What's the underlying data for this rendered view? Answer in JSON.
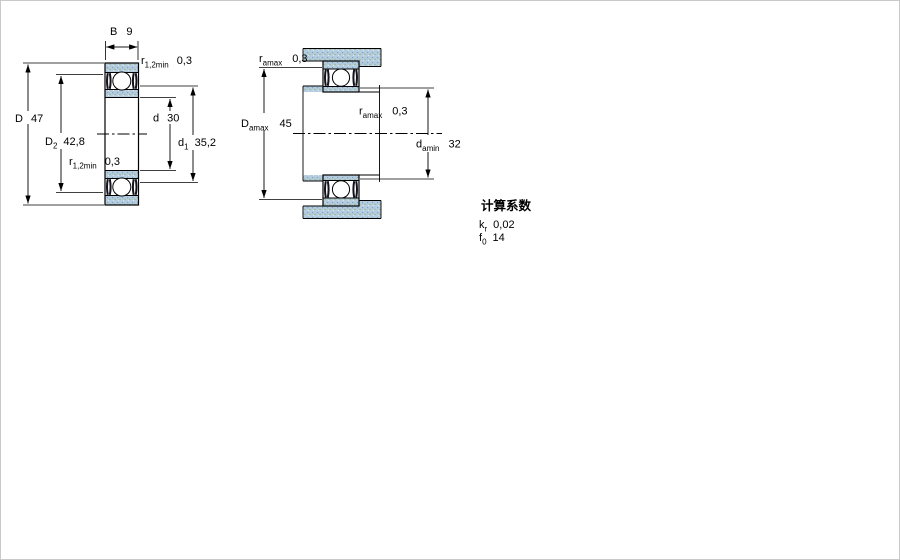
{
  "left_view": {
    "B": {
      "sym": "B",
      "val": "9"
    },
    "r_top": {
      "sym": "r",
      "sub": "1,2min",
      "val": "0,3"
    },
    "D": {
      "sym": "D",
      "val": "47"
    },
    "D2": {
      "sym": "D",
      "sub": "2",
      "val": "42,8"
    },
    "r_bottom": {
      "sym": "r",
      "sub": "1,2min",
      "val": "0,3"
    },
    "d": {
      "sym": "d",
      "val": "30"
    },
    "d1": {
      "sym": "d",
      "sub": "1",
      "val": "35,2"
    }
  },
  "right_view": {
    "ramax_top": {
      "sym": "r",
      "sub": "amax",
      "val": "0,3"
    },
    "Damax": {
      "sym": "D",
      "sub": "amax",
      "val": "45"
    },
    "ramax_mid": {
      "sym": "r",
      "sub": "amax",
      "val": "0,3"
    },
    "damin": {
      "sym": "d",
      "sub": "amin",
      "val": "32"
    }
  },
  "factors": {
    "heading": "计算系数",
    "kr": {
      "sym": "k",
      "sub": "r",
      "val": "0,02"
    },
    "f0": {
      "sym": "f",
      "sub": "0",
      "val": "14"
    }
  },
  "colors": {
    "ring_fill": "#b5ccdf",
    "stipple_dot": "#7ca3c3",
    "seal": "#12121c",
    "line": "#000000",
    "frame": "#c9c9c9"
  }
}
